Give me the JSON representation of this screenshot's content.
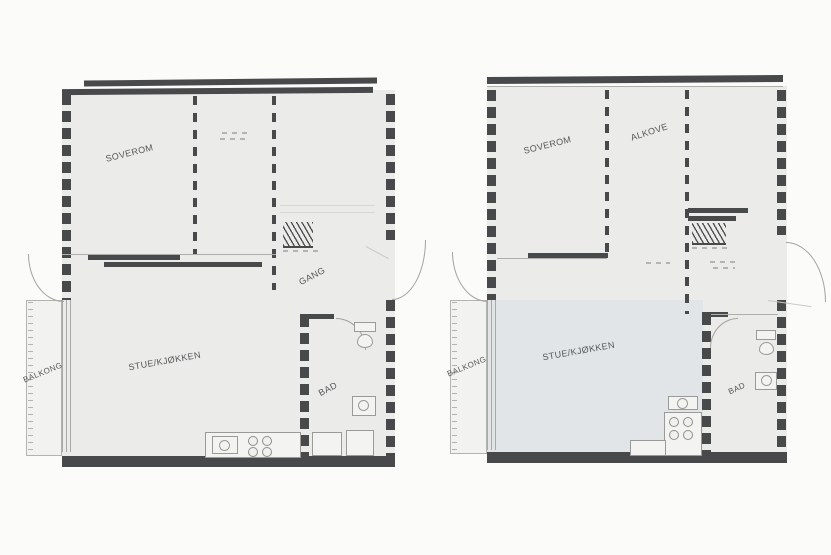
{
  "colors": {
    "bg": "#fbfbfa",
    "floor": "#ebebe9",
    "wall": "#48494b",
    "label": "#46464a",
    "tint": "rgba(206,215,233,0.30)"
  },
  "plan_left": {
    "soverom": "SOVEROM",
    "gang": "GANG",
    "stue_kjokken": "STUE/KJØKKEN",
    "bad": "BAD",
    "balkong": "BALKONG"
  },
  "plan_right": {
    "soverom": "SOVEROM",
    "alkove": "ALKOVE",
    "stue_kjokken": "STUE/KJØKKEN",
    "bad": "BAD",
    "balkong": "BALKONG"
  }
}
